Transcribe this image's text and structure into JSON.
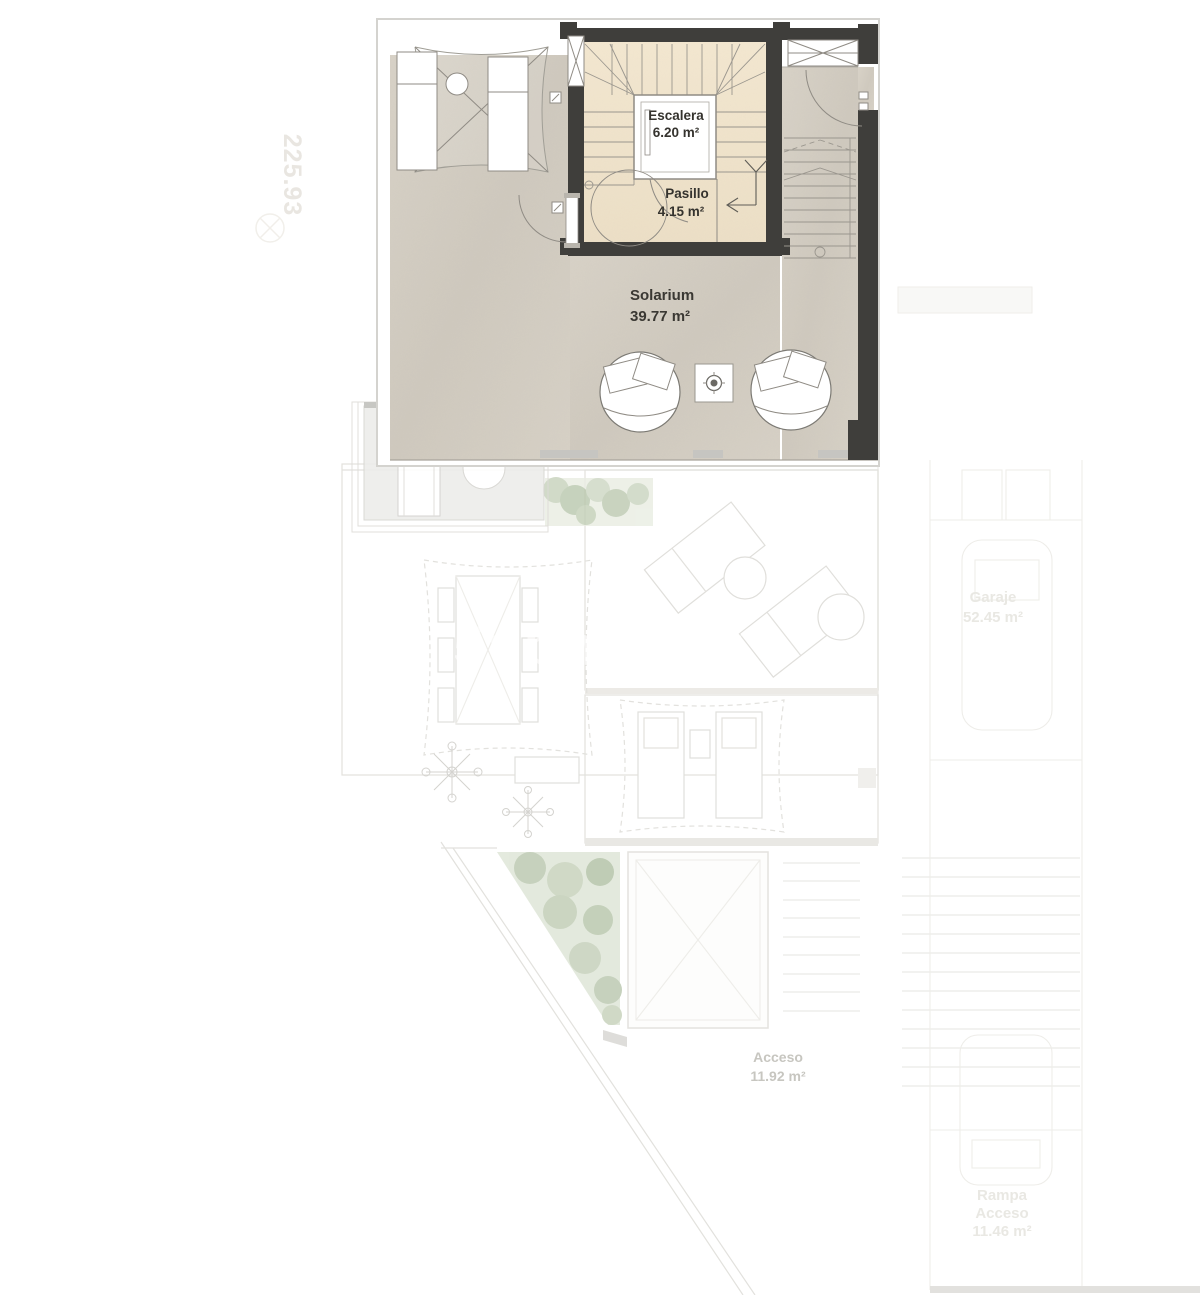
{
  "plan": {
    "watermark": "5vbhh1hk",
    "side_mark": "225.93",
    "rooms": {
      "escalera": {
        "name": "Escalera",
        "area": "6.20 m²"
      },
      "pasillo": {
        "name": "Pasillo",
        "area": "4.15 m²"
      },
      "solarium": {
        "name": "Solarium",
        "area": "39.77 m²"
      },
      "acceso": {
        "name": "Acceso",
        "area": "11.92 m²"
      },
      "garaje": {
        "name": "Garaje",
        "area": "52.45 m²"
      },
      "rampa_acceso": {
        "line1": "Rampa",
        "line2": "Acceso",
        "area": "11.46 m²"
      }
    },
    "colors": {
      "wall": "#3f3e3b",
      "stair_floor": "#f1e5ce",
      "terrace_floor": "#d4cec3",
      "greenery": "#bfcbb4"
    }
  }
}
